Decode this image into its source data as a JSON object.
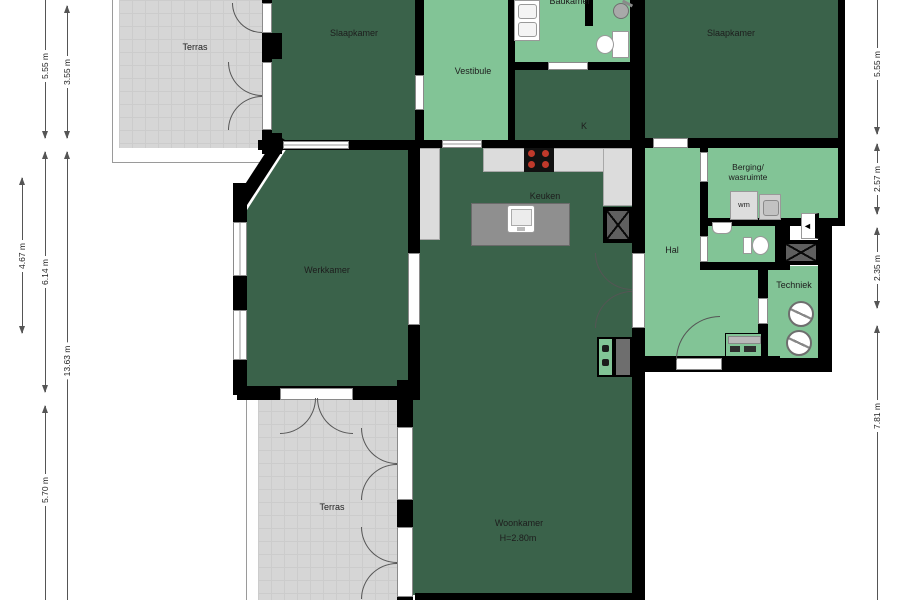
{
  "title": "Floor plan (plattegrond)",
  "rooms": {
    "terras_top": {
      "label": "Terras"
    },
    "slaapkamer_left": {
      "label": "Slaapkamer"
    },
    "vestibule": {
      "label": "Vestibule"
    },
    "badkamer": {
      "label": "Badkamer"
    },
    "closet": {
      "label": "K"
    },
    "slaapkamer_right": {
      "label": "Slaapkamer"
    },
    "keuken": {
      "label": "Keuken"
    },
    "werkkamer": {
      "label": "Werkkamer"
    },
    "hal": {
      "label": "Hal"
    },
    "berging": {
      "line1": "Berging/",
      "line2": "wasruimte"
    },
    "techniek": {
      "label": "Techniek"
    },
    "woonkamer": {
      "label": "Woonkamer",
      "height_note": "H=2.80m"
    },
    "terras_bottom": {
      "label": "Terras"
    }
  },
  "fixtures": {
    "washing_machine_label": "wm"
  },
  "icons": [
    "shower-head-icon",
    "toilet-icon",
    "double-sink-icon",
    "hand-basin-icon",
    "cooktop-icon",
    "kitchen-sink-icon",
    "washing-machine-icon",
    "dryer-icon",
    "boiler-icon",
    "shaft-x-icon",
    "entrance-arrow-icon",
    "door-arc-icon",
    "window-icon"
  ],
  "dimensions": {
    "left": [
      {
        "label": "5.55 m"
      },
      {
        "label": "3.55 m"
      },
      {
        "label": "4.67 m"
      },
      {
        "label": "6.14 m"
      },
      {
        "label": "13.63 m"
      },
      {
        "label": "5.70 m"
      }
    ],
    "right": [
      {
        "label": "5.55 m"
      },
      {
        "label": "2.57 m"
      },
      {
        "label": "2.35 m"
      },
      {
        "label": "7.81 m"
      }
    ]
  },
  "colors": {
    "room_dark_green": "#3a624a",
    "room_light_green": "#82c496",
    "terrace_gray": "#d6d6d6",
    "wall_black": "#000000",
    "counter_gray": "#dcdcdc",
    "island_gray": "#8f8f8f",
    "burner_red": "#c0392b"
  }
}
